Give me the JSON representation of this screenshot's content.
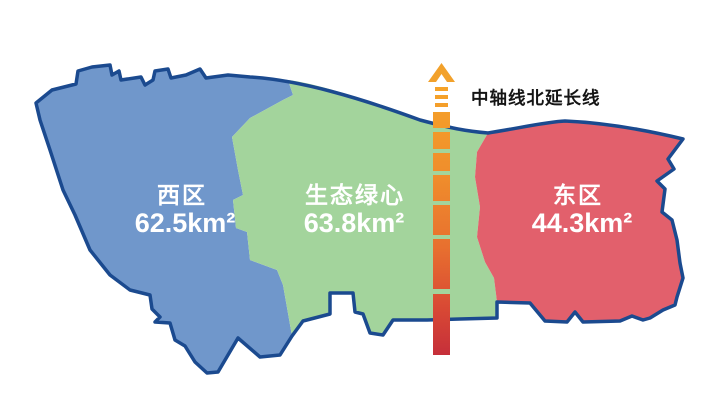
{
  "map": {
    "outline_color": "#1b4a8f",
    "background_color": "#ffffff",
    "label_color": "#ffffff",
    "regions": [
      {
        "id": "west",
        "name": "西区",
        "area": "62.5km²",
        "color": "#7097cb"
      },
      {
        "id": "green-heart",
        "name": "生态绿心",
        "area": "63.8km²",
        "color": "#a3d49c"
      },
      {
        "id": "east",
        "name": "东区",
        "area": "44.3km²",
        "color": "#e2606c"
      }
    ]
  },
  "axis": {
    "label": "中轴线北延长线",
    "label_color": "#151515",
    "arrow_color": "#f2a12b",
    "gradient_top": "#f6a429",
    "gradient_mid1": "#ef8c2c",
    "gradient_mid2": "#e8702f",
    "gradient_mid3": "#d94a34",
    "gradient_bottom": "#c62f3a"
  }
}
